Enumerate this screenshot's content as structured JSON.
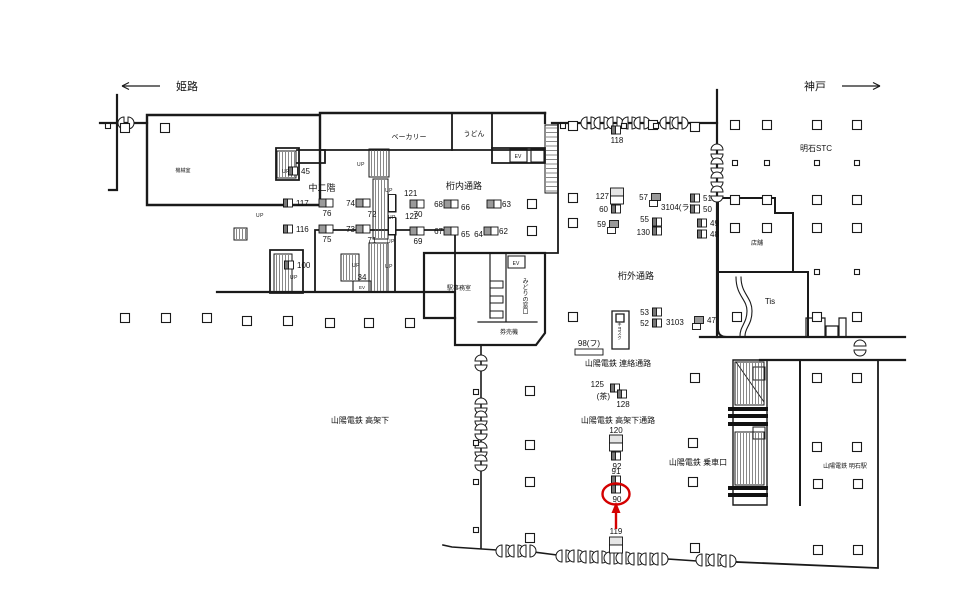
{
  "meta": {
    "background": "#ffffff",
    "ink": "#1a1a1a",
    "highlight_color": "#d40000",
    "up_label": "UP"
  },
  "direction_labels": [
    {
      "text": "姫路",
      "dir": "left",
      "x": 176,
      "y": 90,
      "ax1": 160,
      "ax2": 122,
      "ay": 86
    },
    {
      "text": "神戸",
      "dir": "right",
      "x": 826,
      "y": 90,
      "ax1": 842,
      "ax2": 880,
      "ay": 86
    }
  ],
  "area_labels": [
    {
      "text": "ベーカリー",
      "x": 409,
      "y": 139,
      "fs": 7
    },
    {
      "text": "うどん",
      "x": 474,
      "y": 136,
      "fs": 7
    },
    {
      "text": "中二階",
      "x": 322,
      "y": 191,
      "fs": 9
    },
    {
      "text": "桁内通路",
      "x": 464,
      "y": 189,
      "fs": 9
    },
    {
      "text": "桁外通路",
      "x": 636,
      "y": 279,
      "fs": 9
    },
    {
      "text": "明石STC",
      "x": 816,
      "y": 151,
      "fs": 8
    },
    {
      "text": "店舗",
      "x": 757,
      "y": 245,
      "fs": 6
    },
    {
      "text": "Tis",
      "x": 770,
      "y": 304,
      "fs": 8
    },
    {
      "text": "機械室",
      "x": 183,
      "y": 172,
      "fs": 5
    },
    {
      "text": "駅事務室",
      "x": 459,
      "y": 290,
      "fs": 6
    },
    {
      "text": "みどりの窓口",
      "x": 524,
      "y": 296,
      "fs": 6,
      "vertical": true
    },
    {
      "text": "券売機",
      "x": 509,
      "y": 334,
      "fs": 6
    },
    {
      "text": "キヨスク",
      "x": 620,
      "y": 331,
      "fs": 4.5,
      "vertical": true
    },
    {
      "text": "山陽電鉄 連絡通路",
      "x": 618,
      "y": 366,
      "fs": 8
    },
    {
      "text": "山陽電鉄 高架下通路",
      "x": 618,
      "y": 423,
      "fs": 8
    },
    {
      "text": "山陽電鉄 高架下",
      "x": 360,
      "y": 423,
      "fs": 8
    },
    {
      "text": "山陽電鉄 乗車口",
      "x": 698,
      "y": 465,
      "fs": 8
    },
    {
      "text": "山陽電鉄 明石駅",
      "x": 845,
      "y": 468,
      "fs": 6
    }
  ],
  "facility_labels": [
    {
      "text": "EV",
      "x": 518,
      "y": 158,
      "fs": 5
    },
    {
      "text": "EV",
      "x": 516,
      "y": 265,
      "fs": 5
    },
    {
      "text": "EV",
      "x": 362,
      "y": 289,
      "fs": 4.5
    }
  ],
  "up_positions": [
    [
      286,
      173
    ],
    [
      361,
      166
    ],
    [
      389,
      192
    ],
    [
      392,
      219
    ],
    [
      391,
      243
    ],
    [
      389,
      268
    ],
    [
      294,
      279
    ],
    [
      356,
      267
    ],
    [
      260,
      217
    ]
  ],
  "ad_markers": [
    {
      "n": "45",
      "x": 293,
      "y": 171,
      "s": "single",
      "side": "right"
    },
    {
      "n": "117",
      "x": 288,
      "y": 203,
      "s": "single",
      "side": "right"
    },
    {
      "n": "116",
      "x": 288,
      "y": 229,
      "s": "single",
      "side": "right"
    },
    {
      "n": "76",
      "x": 326,
      "y": 203,
      "s": "pairH",
      "side": "below"
    },
    {
      "n": "75",
      "x": 326,
      "y": 229,
      "s": "pairH",
      "side": "below"
    },
    {
      "n": "74",
      "x": 363,
      "y": 203,
      "s": "pairH",
      "side": "left"
    },
    {
      "n": "72",
      "x": 372,
      "y": 214,
      "s": "label"
    },
    {
      "n": "73",
      "x": 363,
      "y": 229,
      "s": "pairH",
      "side": "left"
    },
    {
      "n": "71",
      "x": 372,
      "y": 240,
      "s": "label"
    },
    {
      "n": "100",
      "x": 289,
      "y": 265,
      "s": "single",
      "side": "right"
    },
    {
      "n": "34",
      "x": 362,
      "y": 277,
      "s": "label"
    },
    {
      "n": "121",
      "x": 392,
      "y": 203,
      "s": "rail",
      "lx": 404,
      "ly": 196,
      "anchor": "start"
    },
    {
      "n": "122",
      "x": 392,
      "y": 226,
      "s": "rail",
      "lx": 405,
      "ly": 219,
      "anchor": "start"
    },
    {
      "n": "70",
      "x": 417,
      "y": 204,
      "s": "pairH",
      "side": "below"
    },
    {
      "n": "69",
      "x": 417,
      "y": 231,
      "s": "pairH",
      "side": "below"
    },
    {
      "n": "68",
      "x": 451,
      "y": 204,
      "s": "pairH",
      "side": "left"
    },
    {
      "n": "66",
      "x": 461,
      "y": 207,
      "s": "label",
      "anchor": "start"
    },
    {
      "n": "63",
      "x": 494,
      "y": 204,
      "s": "pairH",
      "side": "right"
    },
    {
      "n": "67",
      "x": 451,
      "y": 231,
      "s": "pairH",
      "side": "left"
    },
    {
      "n": "65",
      "x": 461,
      "y": 234,
      "s": "label",
      "anchor": "start"
    },
    {
      "n": "64",
      "x": 483,
      "y": 234,
      "s": "label",
      "anchor": "end"
    },
    {
      "n": "62",
      "x": 491,
      "y": 231,
      "s": "pairH",
      "side": "right"
    },
    {
      "n": "118",
      "x": 616,
      "y": 130,
      "s": "single",
      "side": "below"
    },
    {
      "n": "127",
      "x": 617,
      "y": 196,
      "s": "pairV",
      "side": "left"
    },
    {
      "n": "60",
      "x": 616,
      "y": 209,
      "s": "single",
      "side": "left"
    },
    {
      "n": "59",
      "x": 614,
      "y": 224,
      "s": "singleTail",
      "side": "left"
    },
    {
      "n": "57",
      "x": 656,
      "y": 197,
      "s": "singleTail",
      "side": "left"
    },
    {
      "n": "3104(ラ)",
      "x": 661,
      "y": 207,
      "s": "label",
      "anchor": "start"
    },
    {
      "n": "51",
      "x": 695,
      "y": 198,
      "s": "single",
      "side": "right"
    },
    {
      "n": "50",
      "x": 695,
      "y": 209,
      "s": "single",
      "side": "right"
    },
    {
      "n": "55",
      "x": 657,
      "y": 222,
      "s": "single",
      "lx": 649,
      "ly": 222,
      "anchor": "end"
    },
    {
      "n": "130",
      "x": 657,
      "y": 231,
      "s": "single",
      "lx": 650,
      "ly": 235,
      "anchor": "end"
    },
    {
      "n": "49",
      "x": 702,
      "y": 223,
      "s": "single",
      "side": "right"
    },
    {
      "n": "48",
      "x": 702,
      "y": 234,
      "s": "single",
      "side": "right"
    },
    {
      "n": "53",
      "x": 657,
      "y": 312,
      "s": "single",
      "side": "left"
    },
    {
      "n": "52",
      "x": 657,
      "y": 323,
      "s": "single",
      "side": "left"
    },
    {
      "n": "3103",
      "x": 666,
      "y": 322,
      "s": "label",
      "anchor": "start"
    },
    {
      "n": "47",
      "x": 699,
      "y": 320,
      "s": "singleTail",
      "side": "right"
    },
    {
      "n": "98(フ)",
      "x": 589,
      "y": 352,
      "s": "bar",
      "lx": 589,
      "ly": 346
    },
    {
      "n": "125",
      "x": 615,
      "y": 388,
      "s": "single",
      "lx": 604,
      "ly": 387,
      "anchor": "end"
    },
    {
      "n": "(茶)",
      "x": 610,
      "y": 396,
      "s": "label",
      "anchor": "end"
    },
    {
      "n": "128",
      "x": 622,
      "y": 394,
      "s": "single",
      "side": "below"
    },
    {
      "n": "120",
      "x": 616,
      "y": 443,
      "s": "stack2",
      "lx": 616,
      "ly": 433
    },
    {
      "n": "92",
      "x": 616,
      "y": 456,
      "s": "single",
      "side": "below"
    },
    {
      "n": "91",
      "x": 616,
      "y": 480,
      "s": "single",
      "lx": 616,
      "ly": 474
    },
    {
      "n": "90",
      "x": 616,
      "y": 489,
      "s": "single",
      "side": "below"
    },
    {
      "n": "119",
      "x": 616,
      "y": 545,
      "s": "stack2",
      "lx": 616,
      "ly": 534
    }
  ],
  "columns": [
    [
      125,
      128
    ],
    [
      165,
      128
    ],
    [
      573,
      126
    ],
    [
      653,
      125
    ],
    [
      695,
      127
    ],
    [
      735,
      125
    ],
    [
      767,
      125
    ],
    [
      817,
      125
    ],
    [
      857,
      125
    ],
    [
      735,
      163,
      1
    ],
    [
      767,
      163,
      1
    ],
    [
      817,
      163,
      1
    ],
    [
      857,
      163,
      1
    ],
    [
      573,
      198
    ],
    [
      735,
      200
    ],
    [
      767,
      200
    ],
    [
      817,
      200
    ],
    [
      857,
      200
    ],
    [
      573,
      223
    ],
    [
      532,
      204
    ],
    [
      532,
      231
    ],
    [
      735,
      228
    ],
    [
      767,
      228
    ],
    [
      817,
      228
    ],
    [
      857,
      228
    ],
    [
      817,
      272,
      1
    ],
    [
      857,
      272,
      1
    ],
    [
      125,
      318
    ],
    [
      166,
      318
    ],
    [
      207,
      318
    ],
    [
      247,
      321
    ],
    [
      288,
      321
    ],
    [
      330,
      323
    ],
    [
      369,
      323
    ],
    [
      410,
      323
    ],
    [
      573,
      317
    ],
    [
      737,
      317
    ],
    [
      817,
      317
    ],
    [
      857,
      317
    ],
    [
      695,
      378
    ],
    [
      817,
      378
    ],
    [
      857,
      378
    ],
    [
      530,
      391
    ],
    [
      530,
      445
    ],
    [
      693,
      443
    ],
    [
      817,
      447
    ],
    [
      857,
      447
    ],
    [
      530,
      482
    ],
    [
      693,
      482
    ],
    [
      818,
      484
    ],
    [
      858,
      484
    ],
    [
      530,
      538
    ],
    [
      695,
      548
    ],
    [
      818,
      550
    ],
    [
      858,
      550
    ],
    [
      476,
      392,
      1
    ],
    [
      476,
      443,
      1
    ],
    [
      476,
      482,
      1
    ],
    [
      476,
      530,
      1
    ],
    [
      563,
      126,
      1
    ],
    [
      624,
      126,
      1
    ],
    [
      656,
      126,
      1
    ],
    [
      108,
      126,
      1
    ]
  ],
  "highlight": {
    "circled_number": "90",
    "ellipse": {
      "cx": 616,
      "cy": 494,
      "rx": 13.5,
      "ry": 10.5
    },
    "arrow": {
      "x": 616,
      "y_tail": 529,
      "y_head": 509
    }
  }
}
